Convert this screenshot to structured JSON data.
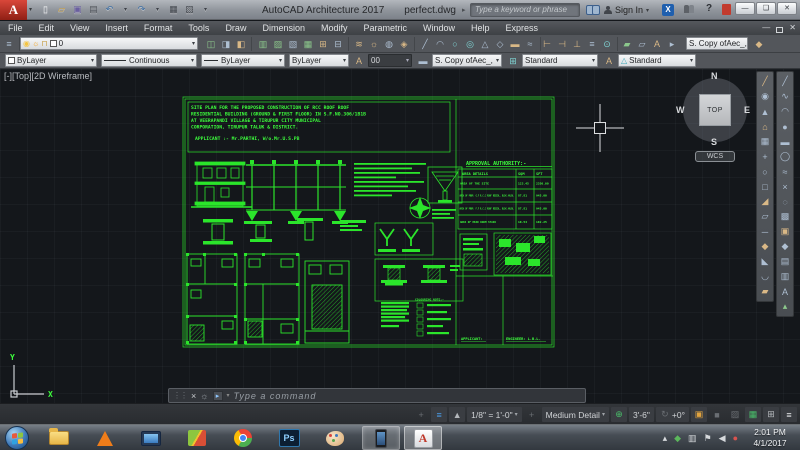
{
  "window": {
    "logo_letter": "A",
    "app_title": "AutoCAD Architecture 2017",
    "doc_title": "perfect.dwg",
    "search_placeholder": "Type a keyword or phrase",
    "sign_in_label": "Sign In",
    "help_glyph": "?"
  },
  "menu": {
    "items": [
      "File",
      "Edit",
      "View",
      "Insert",
      "Format",
      "Tools",
      "Draw",
      "Dimension",
      "Modify",
      "Parametric",
      "Window",
      "Help",
      "Express"
    ]
  },
  "toolbars": {
    "layer_value": "0",
    "tool_style_value": "S. Copy ofAec_,",
    "color_value": "ByLayer",
    "linetype_value": "Continuous",
    "lineweight_value": "ByLayer",
    "plotstyle_value": "ByLayer",
    "text_style_value": "00",
    "aec_style_value": "S. Copy ofAec_,",
    "dim_style_value": "Standard",
    "annot_style_value": "Standard"
  },
  "viewport": {
    "label": "[-][Top][2D Wireframe]",
    "viewcube": {
      "n": "N",
      "e": "E",
      "s": "S",
      "w": "W",
      "top": "TOP",
      "wcs": "WCS"
    },
    "ucs": {
      "x": "X",
      "y": "Y"
    }
  },
  "drawing": {
    "title_lines": [
      "SITE PLAN FOR THE PROPOSED CONSTRUCTION OF RCC ROOF ROOF",
      "RESIDENTIAL BUILDING (GROUND & FIRST FLOOR)  IN S.F.NO.306/1B1B",
      "AT VEERAPANDI VILLAGE & TIRUPUR CITY MUNICIPAL",
      "CORPORATION, TIRUPUR TALUK & DISTRICT.",
      "APPLICANT :- Mr.PARTHI, W/o.Mr.U.S.PB"
    ],
    "approval_title": "APPROVAL AUTHORITY:-",
    "table": {
      "headers": [
        "AREA DETAILS",
        "SQM",
        "SFT"
      ],
      "rows": [
        [
          "AREA OF THE SITE",
          "123.45",
          "2350.00"
        ],
        [
          "AREA OF PROP. G.F R.C.C ROOF RESIDL. BLDG AVLBL",
          "87.81",
          "945.00"
        ],
        [
          "AREA OF PROP. F.F R.C.C ROOF RESIDL. BLDG AVLBL",
          "87.81",
          "945.00"
        ],
        [
          "AREA OF HEAD ROOM STAIR",
          "10.54",
          "102.25"
        ]
      ]
    },
    "legend_title": "COLOURING NOTE:-",
    "applicant_label": "APPLICANT:",
    "engineer_label": "ENGINEER: L.B.L.",
    "line_color": "#2be52b"
  },
  "command_line": {
    "placeholder": "Type a command"
  },
  "status_bar": {
    "scale": "1/8\" = 1'-0\"",
    "detail_level": "Medium Detail",
    "elevation": "3'-6\"",
    "angle": "+0°"
  },
  "taskbar": {
    "ps_label": "Ps",
    "autocad_letter": "A",
    "clock_time": "2:01 PM",
    "clock_date": "4/1/2017"
  },
  "colors": {
    "accent_green": "#2be52b",
    "titlebar_red": "#c03a2b",
    "status_blue": "#4a9ce8"
  }
}
